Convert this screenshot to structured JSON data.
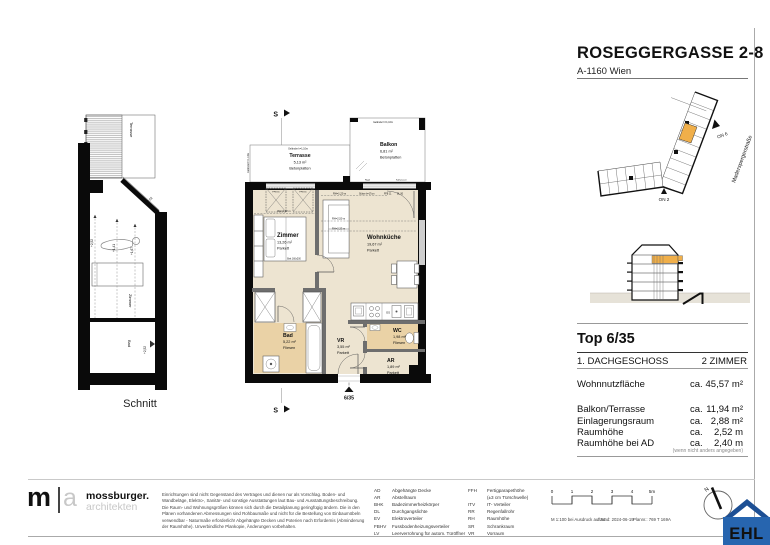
{
  "header": {
    "project": "ROSEGGERGASSE 2-8",
    "address": "A-1160 Wien"
  },
  "site_plan": {
    "street": "Maderspergerstraße",
    "on6": "ON 6",
    "on2": "ON 2"
  },
  "unit": {
    "heading": "Top 6/35",
    "floor_label": "1. DACHGESCHOSS",
    "rooms_label": "2 ZIMMER",
    "metrics": [
      {
        "label": "Wohnnutzfläche",
        "ca": "ca.",
        "value": "45,57 m²"
      },
      {
        "label": "Balkon/Terrasse",
        "ca": "ca.",
        "value": "11,94 m²"
      },
      {
        "label": "Einlagerungsraum",
        "ca": "ca.",
        "value": "2,88 m²"
      },
      {
        "label": "Raumhöhe",
        "ca": "ca.",
        "value": "2,52 m"
      },
      {
        "label": "Raumhöhe bei AD",
        "ca": "ca.",
        "value": "2,40 m"
      }
    ],
    "note": "(wenn nicht anders angegeben)"
  },
  "plan": {
    "marker": "S",
    "entry": "6/35",
    "railing": "Geländer h=1,10m",
    "rooms": [
      {
        "name": "Terrasse",
        "area": "5,13 m²",
        "floor": "Betonplatten"
      },
      {
        "name": "Balkon",
        "area": "6,81 m²",
        "floor": "Betonplatten"
      },
      {
        "name": "Zimmer",
        "area": "13,26 m²",
        "floor": "Parkett"
      },
      {
        "name": "Wohnküche",
        "area": "19,67 m²",
        "floor": "Parkett"
      },
      {
        "name": "Bad",
        "area": "5,22 m²",
        "floor": "Fliesen"
      },
      {
        "name": "VR",
        "area": "3,55 m²",
        "floor": "Parkett"
      },
      {
        "name": "WC",
        "area": "1,98 m²",
        "floor": "Fliesen"
      },
      {
        "name": "AR",
        "area": "1,89 m²",
        "floor": "Parkett"
      }
    ],
    "ann": {
      "rh_zimmer": "RH=2,02 m",
      "rh_wk1": "RH=1,20 m",
      "rh_wk2": "RH=2,50 m",
      "rh_wk3": "RH=2,33 m",
      "stuetze": "Stütze b=17cm",
      "ffb": "FFB 11",
      "dl": "DL 90",
      "rigol": "Rigol",
      "kaltwasser": "Kaltwasser",
      "bett": "Bett 160x200",
      "skylight": "FFB 31",
      "gs": "GS"
    }
  },
  "section_view": {
    "label": "Schnitt",
    "terrace": "Terrasse",
    "zimmer": "Zimmer",
    "bad": "Bad",
    "h1": "+2,52",
    "h2": "+1,41",
    "h3": "+1,67",
    "h4": "+2,52",
    "h5": "+2,52"
  },
  "architect": {
    "m": "m",
    "a": "a",
    "name": "mossburger.",
    "sub": "architekten"
  },
  "disclaimer": [
    "Einrichtungen sind nicht Gegenstand des Vertrages und dienen nur als Vorschlag. Boden- und",
    "Wandbeläge, Elektro-, Sanitär- und sonstige Ausstattungen laut Bau- und Ausstattungsbeschreibung.",
    "Die Raum- und Wohnungsgrößen können sich durch die Detail­planung geringfügig ändern. Die in den",
    "Plänen vorhandenen Abmessungen sind Rohbaumaße und nicht für die Bestellung von Einbaumöbeln",
    "verwendbar - Naturmaße erforderlich! Abgehängte Decken und Poterien nach Erfordernis (Abminderung",
    "der Raumhöhe). Unverbindliche Plankopie, Änderungen vorbehalten."
  ],
  "legend": {
    "left": [
      [
        "AD",
        "Abgehängte Decke"
      ],
      [
        "AR",
        "Abstellraum"
      ],
      [
        "BHK",
        "Badezimmerheizkörper"
      ],
      [
        "DL",
        "Durchgangslichte"
      ],
      [
        "EV",
        "Elektroverteiler"
      ],
      [
        "FBHV",
        "Fussbodenheizungsverteiler"
      ],
      [
        "LV",
        "Leerverrohrung für autom. Türöffner"
      ]
    ],
    "right": [
      [
        "FFH",
        "Fertigparapethöhe"
      ],
      [
        "",
        "(±3 cm Türschwelle)"
      ],
      [
        "ITV",
        "IT- Verteiler"
      ],
      [
        "RR",
        "Regenfallrohr"
      ],
      [
        "RH",
        "Raumhöhe"
      ],
      [
        "SR",
        "Schrankraum"
      ],
      [
        "VR",
        "Vorraum"
      ]
    ]
  },
  "scalebar": {
    "t0": "0",
    "t1": "1",
    "t2": "2",
    "t3": "3",
    "t4": "4",
    "t5": "5m"
  },
  "printinfo": {
    "scale": "M 1:100 bei Ausdruck auf A4",
    "date": "Stand: 2024-06-19",
    "plannr": "Plannr.: 769 T 169A"
  },
  "north": {
    "n": "N"
  },
  "ehl": {
    "text": "EHL"
  },
  "colors": {
    "accent_orange": "#F0AF4A",
    "floor_beige": "#EDE4D1",
    "tile_tan": "#EAD2A6",
    "ehl_blue": "#2765AF",
    "ehl_roof": "#1D4F94",
    "wall_black": "#0A0A0A"
  }
}
